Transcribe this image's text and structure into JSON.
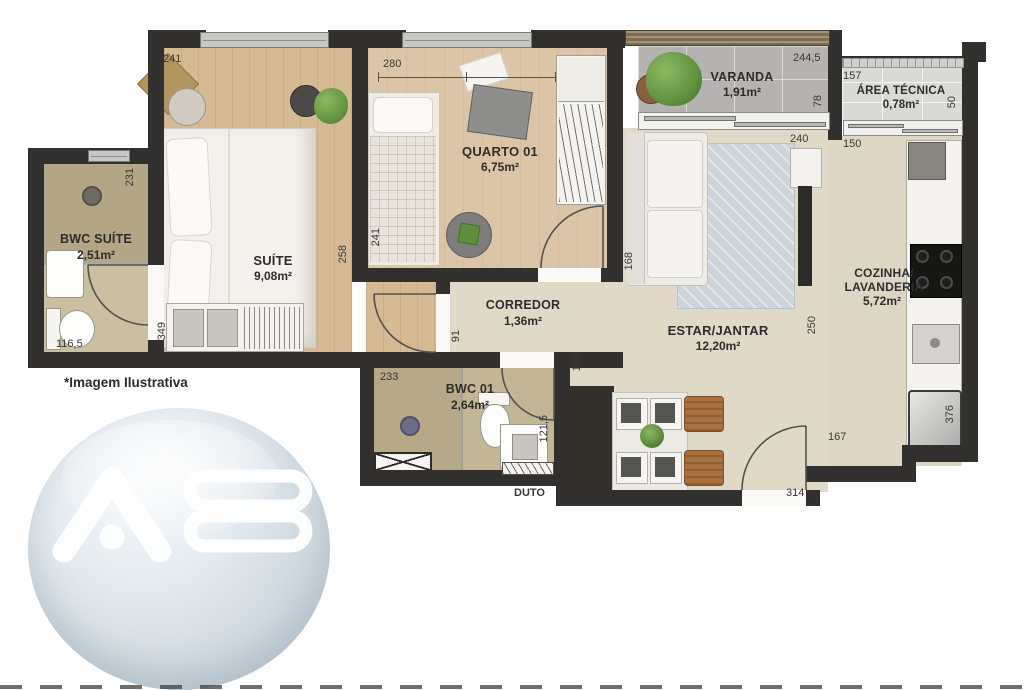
{
  "rooms": {
    "suite": {
      "label": "SUÍTE",
      "area": "9,08m²"
    },
    "bwc_suite": {
      "label": "BWC SUÍTE",
      "area": "2,51m²"
    },
    "quarto01": {
      "label": "QUARTO 01",
      "area": "6,75m²"
    },
    "varanda": {
      "label": "VARANDA",
      "area": "1,91m²"
    },
    "area_tecnica": {
      "label": "ÁREA TÉCNICA",
      "area": "0,78m²"
    },
    "cozinha": {
      "label1": "COZINHA/",
      "label2": "LAVANDERIA",
      "area": "5,72m²"
    },
    "corredor": {
      "label": "CORREDOR",
      "area": "1,36m²"
    },
    "estar": {
      "label": "ESTAR/JANTAR",
      "area": "12,20m²"
    },
    "bwc01": {
      "label": "BWC 01",
      "area": "2,64m²"
    },
    "duto": {
      "label": "DUTO"
    }
  },
  "dims": {
    "suite_top": "241",
    "suite_right": "258",
    "suite_wardrobe": "349",
    "bwc_suite_right": "231",
    "bwc_suite_bottom": "116,5",
    "quarto_top": "280",
    "quarto_left": "241",
    "quarto_right": "168",
    "varanda_top": "244,5",
    "varanda_right": "78",
    "area_tecnica_top": "157",
    "area_tecnica_right": "50",
    "estar_top": "240",
    "cozinha_top": "150",
    "estar_right": "250",
    "corredor": "91",
    "bwc01_top": "233",
    "bwc01_right": "121,5",
    "estar_left": "169",
    "entrance_wall": "167",
    "entrance_door": "314",
    "washer": "376"
  },
  "annotations": {
    "disclaimer": "*Imagem Ilustrativa",
    "watermark_text": "AB"
  },
  "colors": {
    "wall": "#32302e",
    "wood_suite": "#d5ba93",
    "wood_quarto": "#dcc5a6",
    "tile_beige": "#e0d9c8",
    "bwc_tan": "#c2b694",
    "varanda_gray": "#b5b3b1",
    "watermark_blue": "#dde6ec"
  }
}
